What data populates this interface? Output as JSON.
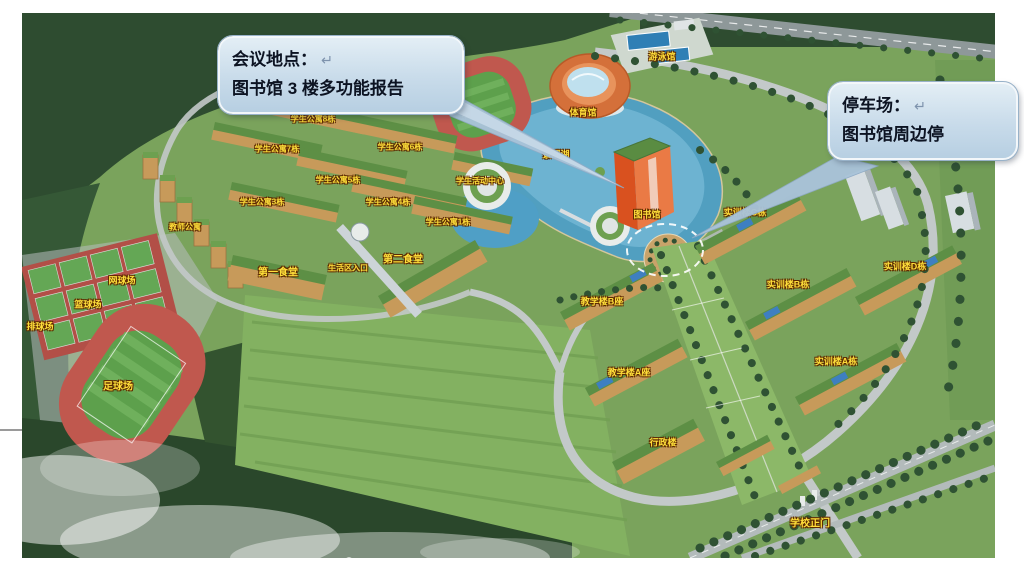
{
  "page": {
    "background_color": "#ffffff",
    "type": "campus-aerial-map-slide"
  },
  "callouts": {
    "meeting": {
      "title": "会议地点：",
      "return_mark": "↵",
      "body": "图书馆 3 楼多功能报告"
    },
    "parking": {
      "title": "停车场：",
      "return_mark": "↵",
      "body": "图书馆周边停"
    }
  },
  "colors": {
    "callout_fill": "#c8dbea",
    "callout_pointer": "#a9c3d9",
    "label_yellow": "#ffdf3a",
    "forest_green": "#2e4c30",
    "lake_blue": "#4f9fc6",
    "track_red": "#c0584e",
    "library_orange": "#dd5a28"
  },
  "map": {
    "type": "campus-aerial-render",
    "labels": [
      {
        "text": "场",
        "x": 452,
        "y": 66,
        "s": 9
      },
      {
        "text": "游泳馆",
        "x": 662,
        "y": 56,
        "s": 9
      },
      {
        "text": "体育馆",
        "x": 583,
        "y": 112,
        "s": 9
      },
      {
        "text": "场",
        "x": 466,
        "y": 114,
        "s": 9
      },
      {
        "text": "学生公寓8栋",
        "x": 313,
        "y": 119,
        "s": 8
      },
      {
        "text": "学生公寓6栋",
        "x": 400,
        "y": 147,
        "s": 8
      },
      {
        "text": "学生公寓7栋",
        "x": 277,
        "y": 149,
        "s": 8
      },
      {
        "text": "景观湖",
        "x": 556,
        "y": 154,
        "s": 9
      },
      {
        "text": "学生公寓5栋",
        "x": 338,
        "y": 180,
        "s": 8
      },
      {
        "text": "学生活动中心",
        "x": 480,
        "y": 181,
        "s": 8
      },
      {
        "text": "学生公寓3栋",
        "x": 262,
        "y": 202,
        "s": 8
      },
      {
        "text": "学生公寓4栋",
        "x": 388,
        "y": 202,
        "s": 8
      },
      {
        "text": "图书馆",
        "x": 647,
        "y": 214,
        "s": 9
      },
      {
        "text": "实训楼C栋",
        "x": 745,
        "y": 212,
        "s": 9
      },
      {
        "text": "学生公寓1栋",
        "x": 448,
        "y": 222,
        "s": 8
      },
      {
        "text": "教师公寓",
        "x": 185,
        "y": 227,
        "s": 8
      },
      {
        "text": "第二食堂",
        "x": 403,
        "y": 258,
        "s": 10
      },
      {
        "text": "实训楼D栋",
        "x": 905,
        "y": 266,
        "s": 9
      },
      {
        "text": "生活区入口",
        "x": 348,
        "y": 268,
        "s": 8
      },
      {
        "text": "第一食堂",
        "x": 278,
        "y": 271,
        "s": 10
      },
      {
        "text": "网球场",
        "x": 122,
        "y": 280,
        "s": 9
      },
      {
        "text": "实训楼B栋",
        "x": 788,
        "y": 284,
        "s": 9
      },
      {
        "text": "教学楼B座",
        "x": 602,
        "y": 301,
        "s": 9
      },
      {
        "text": "篮球场",
        "x": 88,
        "y": 304,
        "s": 9
      },
      {
        "text": "排球场",
        "x": 40,
        "y": 326,
        "s": 9
      },
      {
        "text": "实训楼A栋",
        "x": 836,
        "y": 361,
        "s": 9
      },
      {
        "text": "教学楼A座",
        "x": 629,
        "y": 372,
        "s": 9
      },
      {
        "text": "足球场",
        "x": 118,
        "y": 385,
        "s": 10
      },
      {
        "text": "行政楼",
        "x": 663,
        "y": 442,
        "s": 9
      },
      {
        "text": "学校正门",
        "x": 810,
        "y": 522,
        "s": 10
      }
    ]
  }
}
